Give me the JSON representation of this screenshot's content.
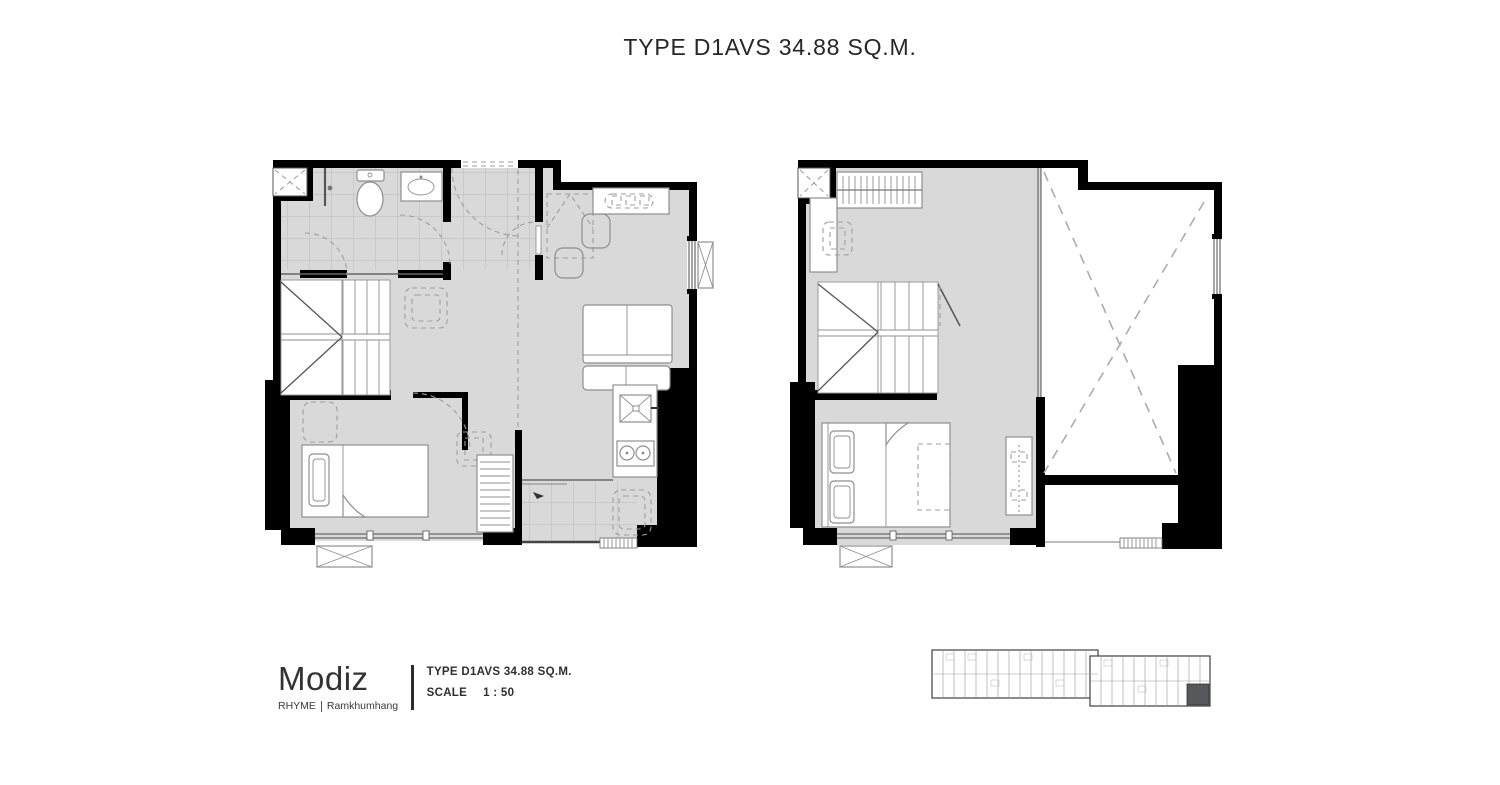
{
  "title": "TYPE D1AVS 34.88 SQ.M.",
  "footer": {
    "brand": "Modiz",
    "series": "RHYME",
    "location": "Ramkhumhang",
    "type_label": "TYPE D1AVS 34.88 SQ.M.",
    "scale_label": "SCALE",
    "scale_value": "1 : 50"
  },
  "colors": {
    "wall": "#000000",
    "floor": "#d9d9d9",
    "tile": "#c4c4c4",
    "furn": "#8f8f8f",
    "dash": "#9e9e9e",
    "keyplan_highlight": "#57585a",
    "background": "#ffffff"
  }
}
